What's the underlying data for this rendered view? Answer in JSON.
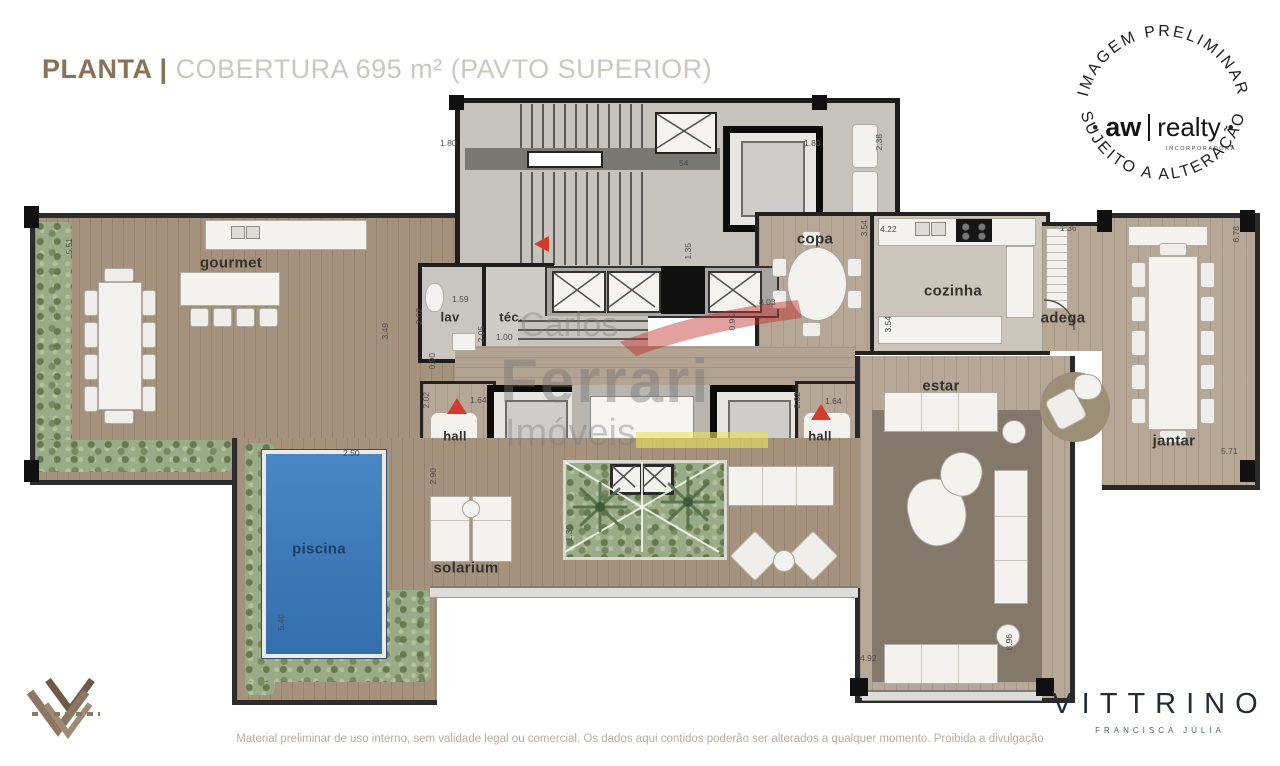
{
  "header": {
    "title_strong": "PLANTA |",
    "title_light": "COBERTURA 695 m² (PAVTO SUPERIOR)"
  },
  "stamp": {
    "arc_top": "IMAGEM PRELIMINAR",
    "arc_bottom": "SUJEITO A ALTERAÇÃO",
    "dot_left": "•",
    "dot_right": "•",
    "brand_a": "aw",
    "brand_b": "realty",
    "brand_sub": "INCORPORADORA"
  },
  "watermark": {
    "l1": "Carlos",
    "l2": "Ferrari",
    "l3": "Imóveis"
  },
  "rooms": {
    "gourmet": "gourmet",
    "lav": "lav",
    "tec": "téc.",
    "copa": "copa",
    "cozinha": "cozinha",
    "adega": "adega",
    "estar": "estar",
    "jantar": "jantar",
    "hall_left": "hall",
    "hall_right": "hall",
    "piscina": "piscina",
    "solarium": "solarium"
  },
  "dimensions": {
    "d01": "1.80",
    "d02": "54",
    "d03": "1.80",
    "d04": "2.38",
    "d05": "4.22",
    "d06": "1.36",
    "d07": "6.78",
    "d08": "5.51",
    "d09": "3.49",
    "d10": "1.59",
    "d11": "2.02",
    "d12": "2.05",
    "d13": "1.00",
    "d14": "0.90",
    "d15": "1.35",
    "d16": "8.03",
    "d17": "0.95",
    "d18": "3.54",
    "d19": "3.54",
    "d20": "2.02",
    "d21": "1.64",
    "d22": "2.02",
    "d23": "1.64",
    "d24": "2.90",
    "d25": "2.50",
    "d26": "5.40",
    "d27": "1.30",
    "d28": "4.92",
    "d29": "8.96",
    "d30": "5.71"
  },
  "footer": {
    "disclaimer": "Material preliminar de uso interno, sem validade legal ou comercial. Os dados aqui contidos poderão ser alterados a qualquer momento. Proibida a divulgação",
    "brand": "VITTRINO",
    "brand_sub": "FRANCISCA JÚLIA"
  },
  "colors": {
    "accent_brown": "#8a7055",
    "title_light_gray": "#ccc6bf",
    "pool_blue": "#3f80bf",
    "marker_red": "#d6392e",
    "watermark_yellow": "#e9e25a",
    "greenery": "#9aab88",
    "wall_black": "#101010",
    "wood_floor": "#b6a797"
  }
}
